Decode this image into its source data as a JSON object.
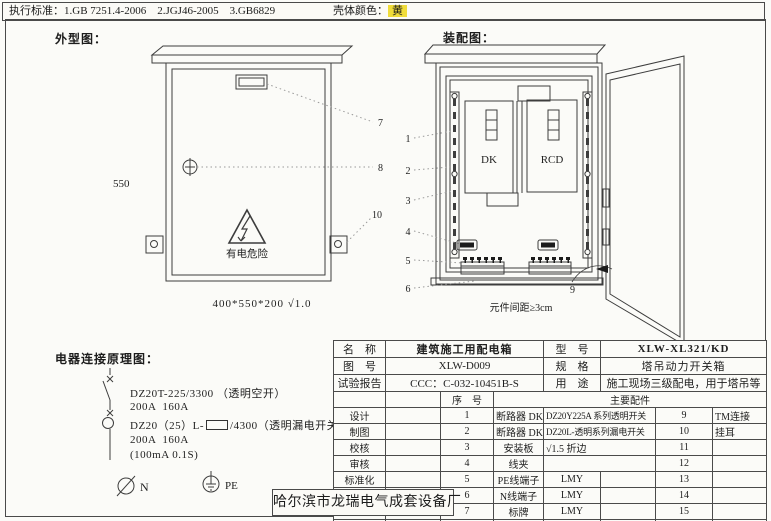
{
  "header": {
    "standards_label": "执行标准：",
    "standards": "1.GB 7251.4-2006    2.JGJ46-2005    3.GB6829",
    "shell_color_label": "壳体颜色：",
    "shell_color_value": "黄"
  },
  "outline": {
    "title": "外型图：",
    "height_dim": "550",
    "warning_text": "有电危险",
    "size_note": "400*550*200 √1.0",
    "callout_7": "7",
    "callout_8": "8",
    "callout_10": "10"
  },
  "assembly": {
    "title": "装配图：",
    "dk_label": "DK",
    "rcd_label": "RCD",
    "callouts": [
      "1",
      "2",
      "3",
      "4",
      "5",
      "6"
    ],
    "door_callout": "9",
    "spacing_note": "元件间距≥3cm"
  },
  "schematic": {
    "title": "电器连接原理图：",
    "line1": "DZ20T-225/3300 （透明空开）",
    "line2": "200A  160A",
    "line3_prefix": "DZ20（25）L-",
    "line3_suffix": "/4300（透明漏电开关）",
    "line4": "200A  160A",
    "line5": "(100mA 0.1S)",
    "n_label": "N",
    "pe_label": "PE"
  },
  "table": {
    "info": [
      {
        "k": "名　称",
        "v": "建筑施工用配电箱",
        "k2": "型　号",
        "v2": "XLW-XL321/KD"
      },
      {
        "k": "图　号",
        "v": "XLW-D009",
        "k2": "规　格",
        "v2": "塔吊动力开关箱"
      },
      {
        "k": "试验报告",
        "v": "CCC：C-032-10451B-S",
        "k2": "用　途",
        "v2": "施工现场三级配电，用于塔吊等"
      }
    ],
    "seq_header": "序　号",
    "parts_header": "主要配件",
    "sign_labels": [
      "设计",
      "制图",
      "校核",
      "审核",
      "标准化",
      "日期"
    ],
    "parts": [
      {
        "no": "1",
        "name": "断路器 DK",
        "desc": "DZ20Y225A 系列透明开关",
        "no2": "9",
        "desc2": "TM连接"
      },
      {
        "no": "2",
        "name": "断路器 DK",
        "desc": "DZ20L-透明系列漏电开关",
        "no2": "10",
        "desc2": "挂耳"
      },
      {
        "no": "3",
        "name": "安装板",
        "desc": "√1.5 折边",
        "no2": "11",
        "desc2": ""
      },
      {
        "no": "4",
        "name": "线夹",
        "desc": "",
        "no2": "12",
        "desc2": ""
      },
      {
        "no": "5",
        "name": "PE线端子",
        "desc": "LMY",
        "no2": "13",
        "desc2": ""
      },
      {
        "no": "6",
        "name": "N线端子",
        "desc": "LMY",
        "no2": "14",
        "desc2": ""
      },
      {
        "no": "7",
        "name": "标牌",
        "desc": "LMY",
        "no2": "15",
        "desc2": ""
      },
      {
        "no": "8",
        "name": "压把锁孔",
        "desc": "防雨",
        "no2": "16",
        "desc2": ""
      }
    ]
  },
  "factory": "哈尔滨市龙瑞电气成套设备厂",
  "colors": {
    "line": "#4a4a4a",
    "highlight_yellow": "#f0dc3a",
    "paper": "#fbfbf8"
  }
}
